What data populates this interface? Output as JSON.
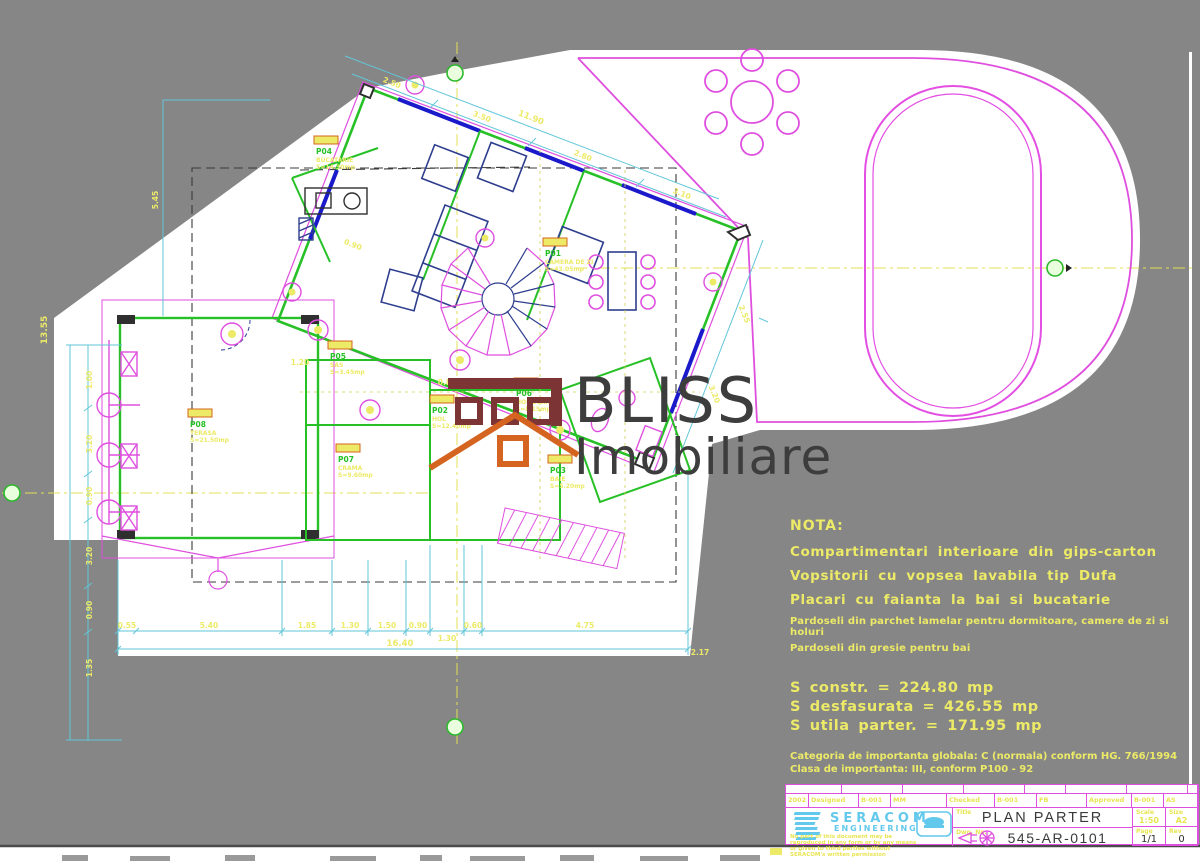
{
  "watermark": {
    "brand": "BLISS",
    "sub": "Imobiliare"
  },
  "nota": {
    "heading": "NOTA:",
    "lines": [
      "Compartimentari interioare din gips-carton",
      "Vopsitorii cu vopsea lavabila tip Dufa",
      "Placari cu faianta la bai si bucatarie"
    ],
    "small_lines": [
      "Pardoseli din parchet lamelar pentru dormitoare, camere de zi si holuri",
      "Pardoseli din gresie pentru bai"
    ]
  },
  "stats": {
    "lines": [
      "S constr.  =  224.80 mp",
      "S desfasurata  =  426.55 mp",
      "S utila parter.  =  171.95 mp"
    ],
    "small_lines": [
      "Categoria de importanta globala: C (normala) conform HG. 766/1994",
      "Clasa de importanta: III, conform P100 - 92"
    ]
  },
  "title_block": {
    "company": "SERACOM",
    "company_sub": "ENGINEERING",
    "disclaimer": "No part of this document may be reproduced in any form or by any means or given to third parties without SERACOM's written permission",
    "row_fields": [
      "2002",
      "Designed",
      "B-001",
      "MM",
      "Checked",
      "B-001",
      "FB",
      "Approved",
      "B-001",
      "AS"
    ],
    "title_label": "Title",
    "title": "PLAN PARTER",
    "dwg_label": "Dwg. No.",
    "dwg_no": "545-AR-0101",
    "scale_label": "Scale",
    "scale": "1:50",
    "format_label": "Size",
    "format": "A2",
    "page_label": "Page",
    "page": "1/1",
    "rev_label": "Rev",
    "rev": "0"
  },
  "rooms": [
    {
      "code": "P01",
      "name": "CAMERA DE ZI",
      "area": "S=43.05mp"
    },
    {
      "code": "P02",
      "name": "HOL",
      "area": "S=12.40mp"
    },
    {
      "code": "P03",
      "name": "BAIE",
      "area": "S=5.20mp"
    },
    {
      "code": "P04",
      "name": "BUCATARIE",
      "area": "S=14.30mp"
    },
    {
      "code": "P05",
      "name": "SAS",
      "area": "S=3.45mp"
    },
    {
      "code": "P06",
      "name": "HOL SCARA",
      "area": "S=8.15mp"
    },
    {
      "code": "P07",
      "name": "CRAMA",
      "area": "S=9.60mp"
    },
    {
      "code": "P08",
      "name": "TERASA",
      "area": "S=21.50mp"
    }
  ],
  "dims": {
    "bottom": [
      "0.55",
      "5.40",
      "1.85",
      "1.30",
      "1.50",
      "0.90",
      "1.30",
      "0.60",
      "4.75"
    ],
    "bottom_total": "16.40",
    "left": [
      "1.00",
      "3.20",
      "0.90",
      "3.20",
      "0.90",
      "1.35"
    ],
    "left_total": "13.55",
    "top": [
      "2.50",
      "3.50",
      "2.80",
      "3.10"
    ],
    "top_total": "11.90",
    "right": [
      "2.55",
      "3.20"
    ],
    "misc": [
      "0.90",
      "0.80",
      "1.20",
      "5.45",
      "2.17"
    ]
  },
  "colors": {
    "background": "#868686",
    "magenta": "#df4fdf",
    "cyan": "#62c6d9",
    "green": "#27c127",
    "yellow": "#ecea67",
    "navy": "#2e3e8e",
    "window_blue": "#1a1acb",
    "maroon": "#7c3434",
    "orange": "#d4641f",
    "seracom_cyan": "#63c9ec"
  }
}
